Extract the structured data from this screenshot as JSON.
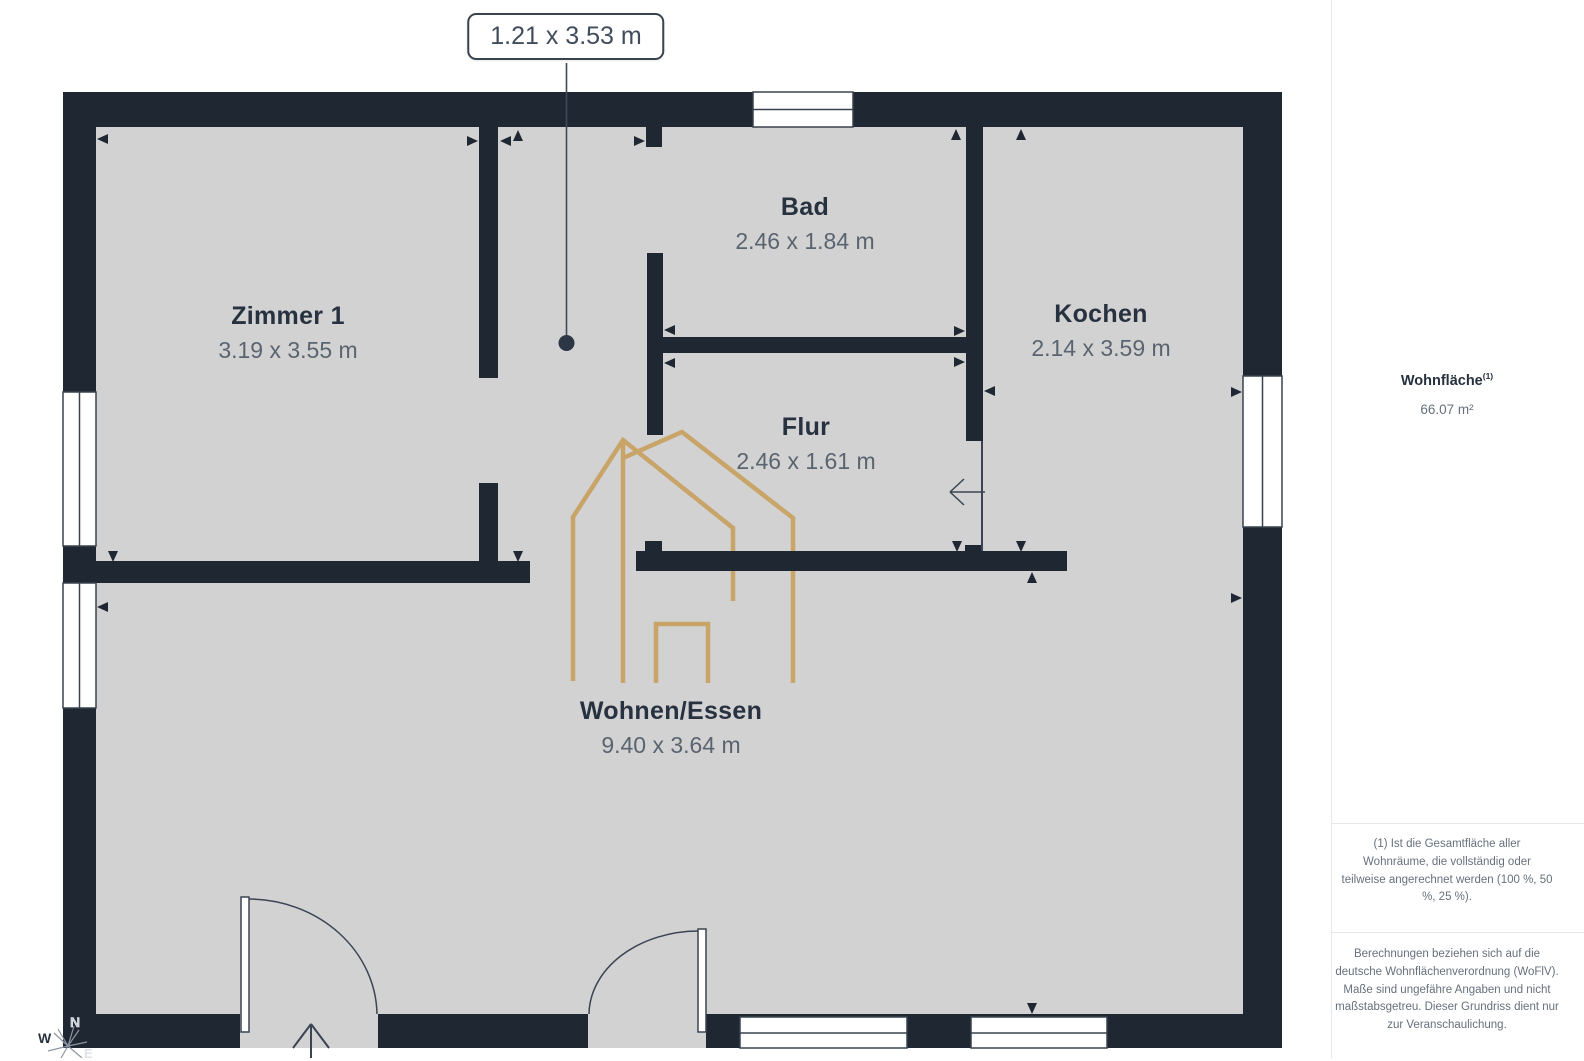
{
  "callout": {
    "label": "1.21 x 3.53 m"
  },
  "rooms": [
    {
      "name": "Zimmer 1",
      "dims": "3.19 x 3.55 m"
    },
    {
      "name": "Bad",
      "dims": "2.46 x 1.84 m"
    },
    {
      "name": "Kochen",
      "dims": "2.14 x 3.59 m"
    },
    {
      "name": "Flur",
      "dims": "2.46 x 1.61 m"
    },
    {
      "name": "Wohnen/Essen",
      "dims": "9.40 x 3.64 m"
    }
  ],
  "compass": {
    "north": "N",
    "west": "W",
    "east": "E"
  },
  "sidebar": {
    "area_label": "Wohnfläche",
    "area_marker": "(1)",
    "area_value": "66.07 m²",
    "footnote": "(1) Ist die Gesamtfläche aller Wohnräume, die vollständig oder teilweise angerechnet werden (100 %, 50 %, 25 %).",
    "disclaimer": "Berechnungen beziehen sich auf die deutsche Wohnflächenverordnung (WoFlV). Maße sind ungefähre Angaben und nicht maßstabsgetreu. Dieser Grundriss dient nur zur Veranschaulichung."
  },
  "colors": {
    "wall": "#1f2733",
    "floor": "#d2d2d2",
    "watermark_gold": "#c8a264",
    "callout_text": "#414d5c",
    "muted_text": "#67707c"
  }
}
